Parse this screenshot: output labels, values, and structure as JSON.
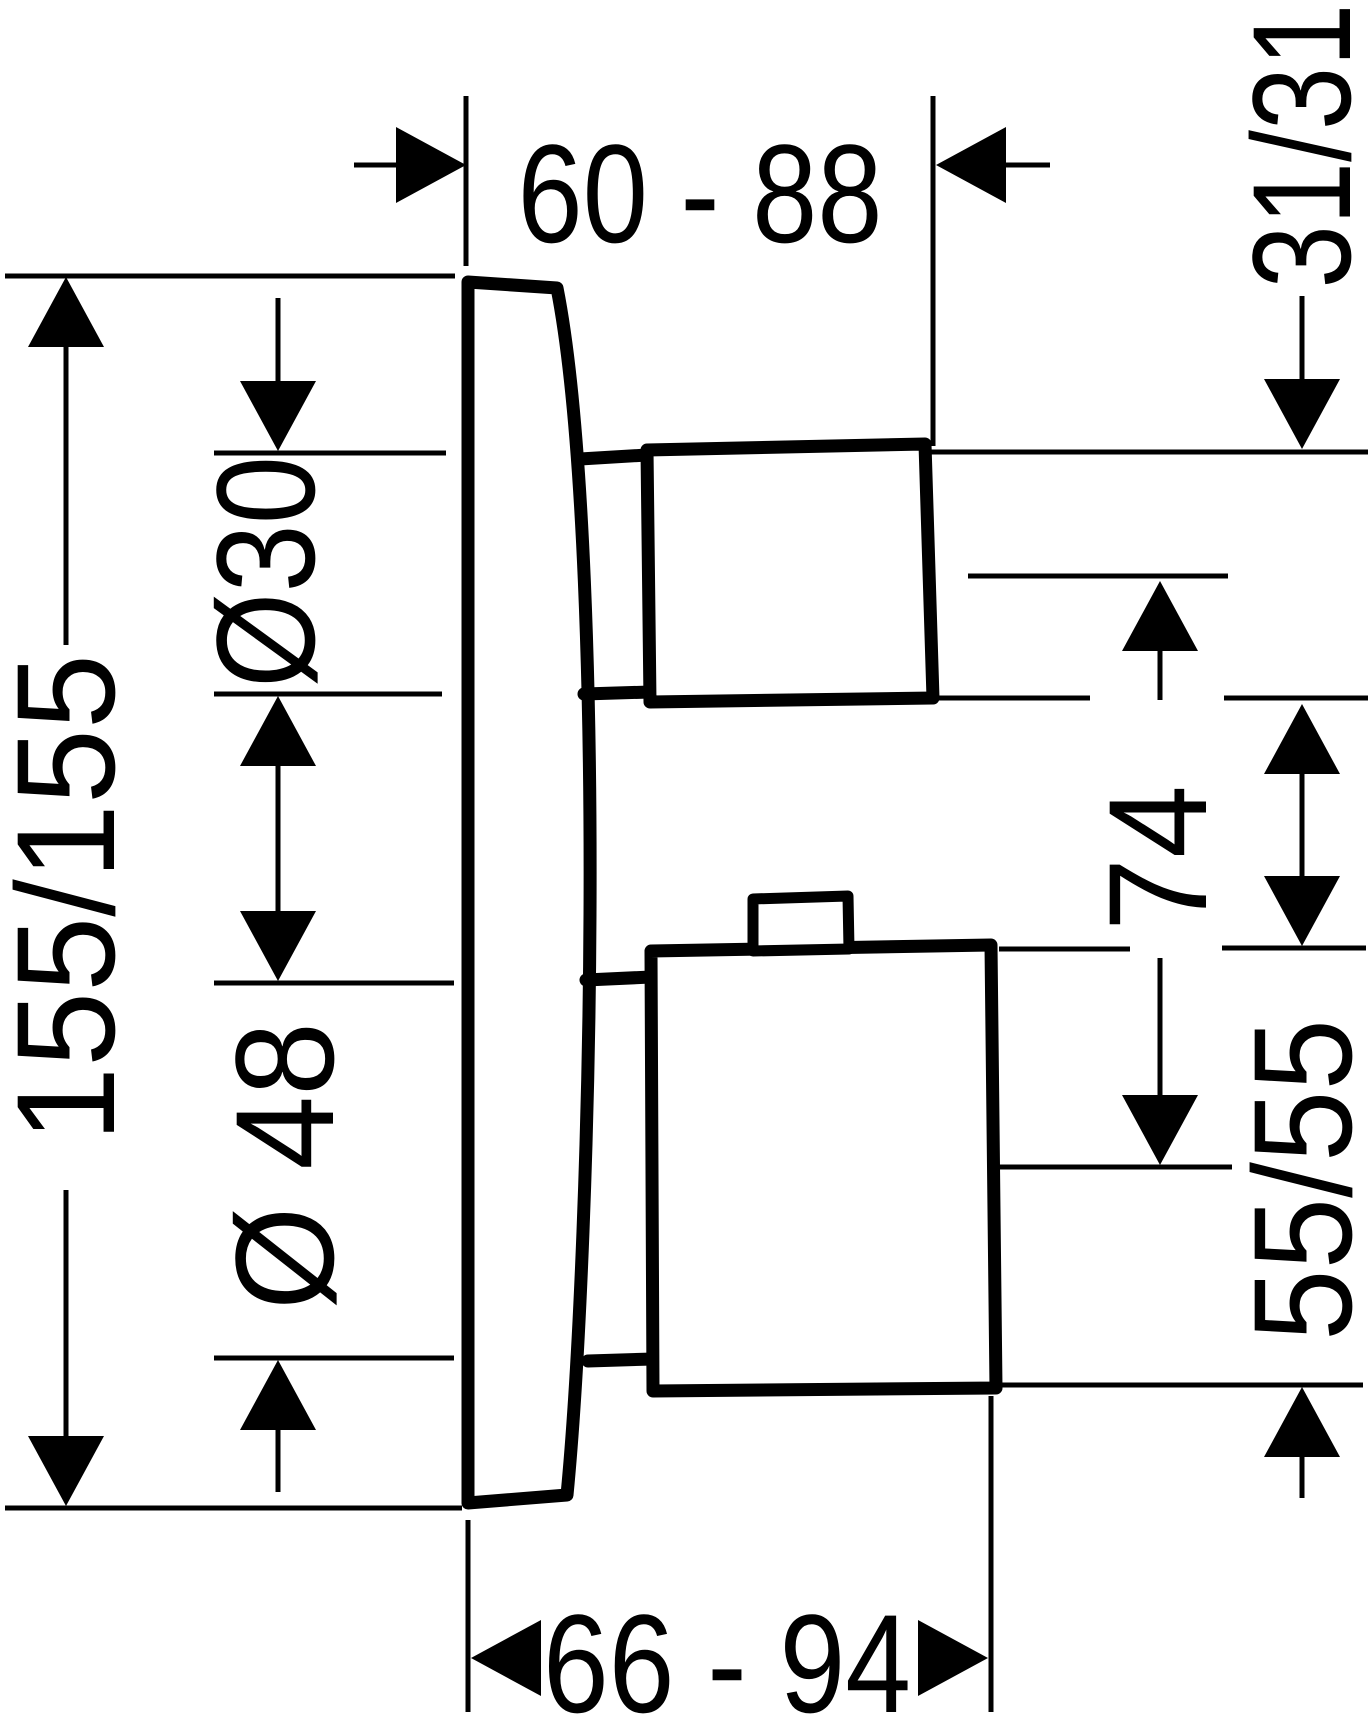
{
  "drawing": {
    "description": "Technical side-view dimension drawing of a concealed shower thermostat with wall plate and two handles",
    "background_color": "#ffffff",
    "line_color": "#000000",
    "dimensions": {
      "top_depth": "60 - 88",
      "upper_handle_square": "31/31",
      "upper_sleeve_diameter": "Ø30",
      "plate_square": "155/155",
      "lower_sleeve_diameter": "Ø 48",
      "handle_center_distance": "74",
      "lower_handle_square": "55/55",
      "bottom_depth": "66 - 94"
    }
  }
}
